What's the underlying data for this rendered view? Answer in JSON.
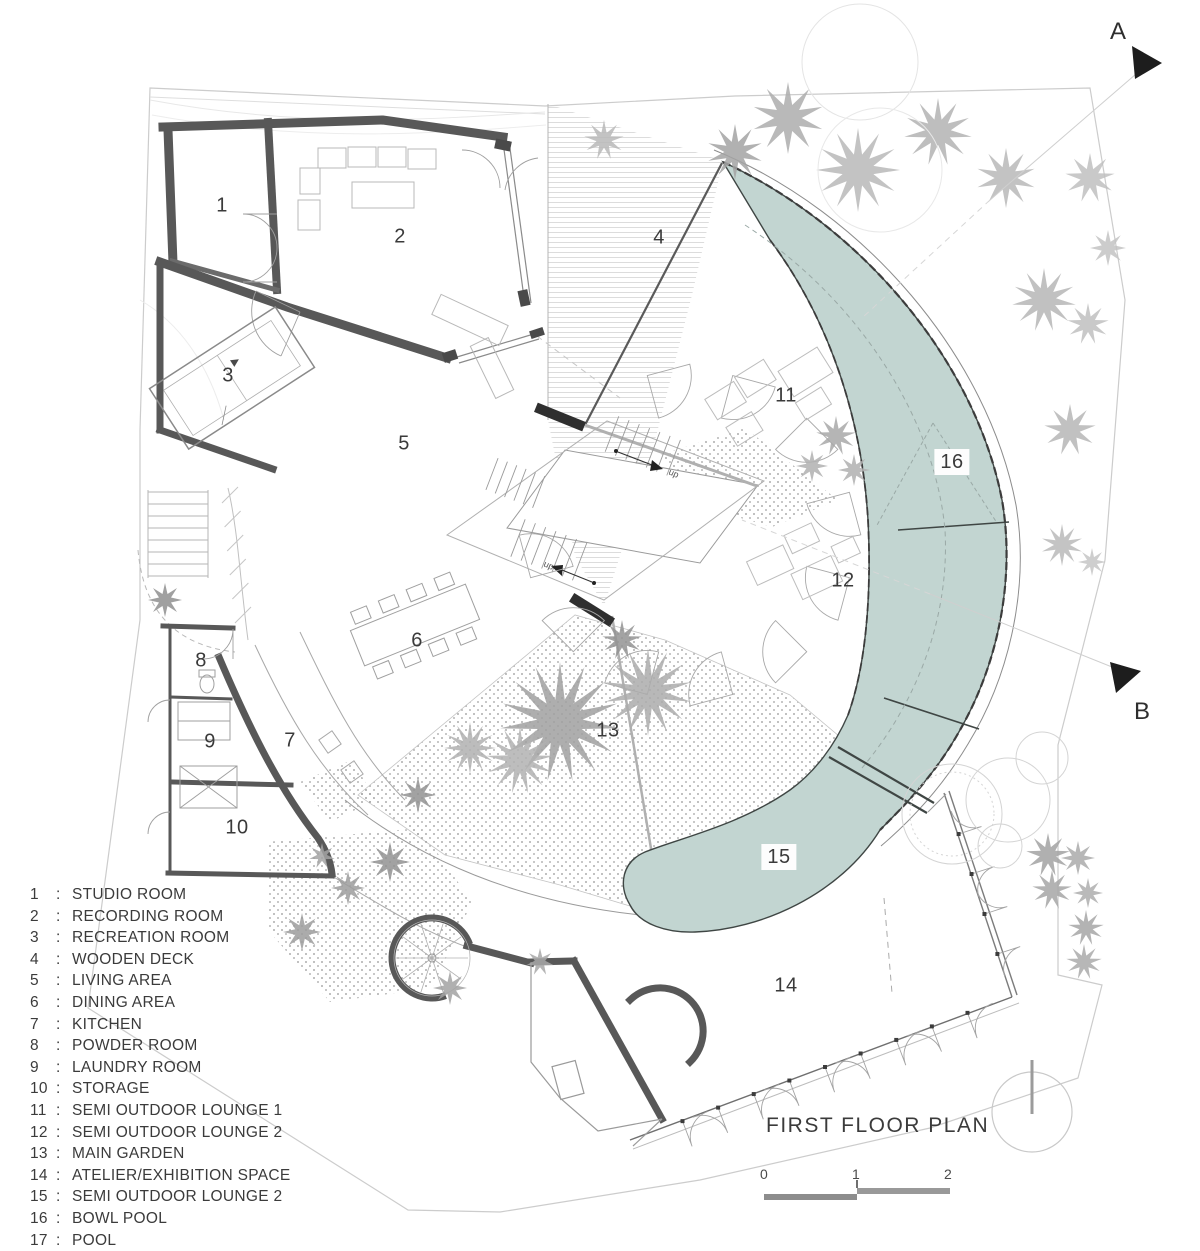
{
  "title": "FIRST FLOOR PLAN",
  "section_markers": {
    "a": "A",
    "b": "B"
  },
  "scale_bar": {
    "ticks": [
      "0",
      "1",
      "2"
    ]
  },
  "legend": {
    "separator": ":",
    "items": [
      {
        "num": "1",
        "name": "STUDIO ROOM"
      },
      {
        "num": "2",
        "name": "RECORDING ROOM"
      },
      {
        "num": "3",
        "name": "RECREATION ROOM"
      },
      {
        "num": "4",
        "name": "WOODEN DECK"
      },
      {
        "num": "5",
        "name": "LIVING AREA"
      },
      {
        "num": "6",
        "name": "DINING AREA"
      },
      {
        "num": "7",
        "name": "KITCHEN"
      },
      {
        "num": "8",
        "name": "POWDER ROOM"
      },
      {
        "num": "9",
        "name": "LAUNDRY ROOM"
      },
      {
        "num": "10",
        "name": "STORAGE"
      },
      {
        "num": "11",
        "name": "SEMI OUTDOOR LOUNGE 1"
      },
      {
        "num": "12",
        "name": "SEMI OUTDOOR LOUNGE 2"
      },
      {
        "num": "13",
        "name": "MAIN GARDEN"
      },
      {
        "num": "14",
        "name": "ATELIER/EXHIBITION SPACE"
      },
      {
        "num": "15",
        "name": "SEMI OUTDOOR LOUNGE 2"
      },
      {
        "num": "16",
        "name": "BOWL POOL"
      },
      {
        "num": "17",
        "name": "POOL"
      }
    ]
  },
  "plan": {
    "stair_up_label": "up",
    "room_labels": [
      {
        "num": "1",
        "x": 222,
        "y": 206
      },
      {
        "num": "2",
        "x": 400,
        "y": 237
      },
      {
        "num": "3",
        "x": 228,
        "y": 376
      },
      {
        "num": "4",
        "x": 659,
        "y": 238
      },
      {
        "num": "5",
        "x": 404,
        "y": 444
      },
      {
        "num": "6",
        "x": 417,
        "y": 641
      },
      {
        "num": "7",
        "x": 290,
        "y": 741
      },
      {
        "num": "8",
        "x": 201,
        "y": 661
      },
      {
        "num": "9",
        "x": 210,
        "y": 742
      },
      {
        "num": "10",
        "x": 237,
        "y": 828
      },
      {
        "num": "11",
        "x": 786,
        "y": 396
      },
      {
        "num": "12",
        "x": 843,
        "y": 581
      },
      {
        "num": "13",
        "x": 608,
        "y": 731
      },
      {
        "num": "14",
        "x": 786,
        "y": 986
      },
      {
        "num": "15",
        "x": 779,
        "y": 857,
        "chip": true
      },
      {
        "num": "16",
        "x": 952,
        "y": 462,
        "chip": true
      }
    ]
  },
  "colors": {
    "pool_fill": "#c2d5d1",
    "wall": "#595959",
    "text": "#3b3b3b",
    "line_light": "#c9c9c9"
  }
}
